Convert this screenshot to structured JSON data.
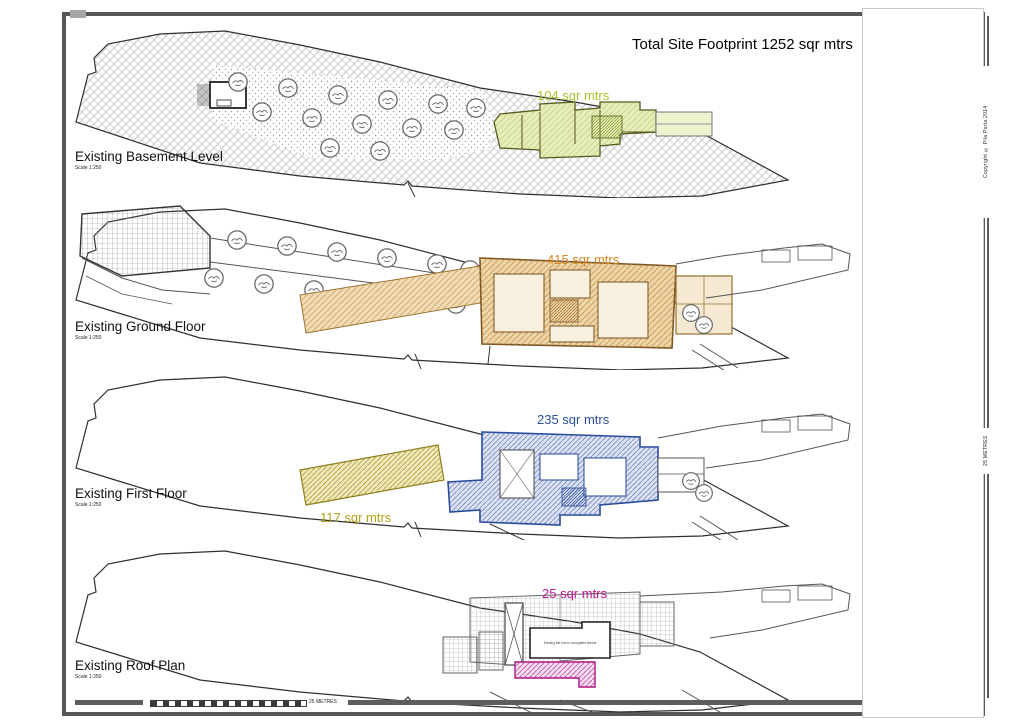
{
  "page": {
    "title": "Total Site Footprint 1252 sqr mtrs",
    "copyright": "Copyright © Pila Porta 2014",
    "scalebar": {
      "horizontal_label": "25 METRES",
      "vertical_label": "25 METRES"
    }
  },
  "totals": {
    "site_footprint_sqm": 1252
  },
  "plans": [
    {
      "id": "basement",
      "name": "Existing Basement Level",
      "scale": "Scale 1:250",
      "area": {
        "label": "104 sqr mtrs",
        "value": 104,
        "color": "#a8c42d"
      }
    },
    {
      "id": "ground",
      "name": "Existing Ground Floor",
      "scale": "Scale 1:250",
      "area": {
        "label": "415 sqr mtrs",
        "value": 415,
        "color": "#d5861f"
      }
    },
    {
      "id": "first",
      "name": "Existing First Floor",
      "scale": "Scale 1:250",
      "area": {
        "label": "235 sqr mtrs",
        "value": 235,
        "color": "#2a4f9f"
      },
      "secondary_area": {
        "label": "117 sqr mtrs",
        "value": 117,
        "color": "#b3a016"
      }
    },
    {
      "id": "roof",
      "name": "Existing Roof Plan",
      "scale": "Scale 1:250",
      "area": {
        "label": "25 sqr mtrs",
        "value": 25,
        "color": "#c11492"
      },
      "roof_note": "Existing flat roof to corrugated sheets"
    }
  ]
}
